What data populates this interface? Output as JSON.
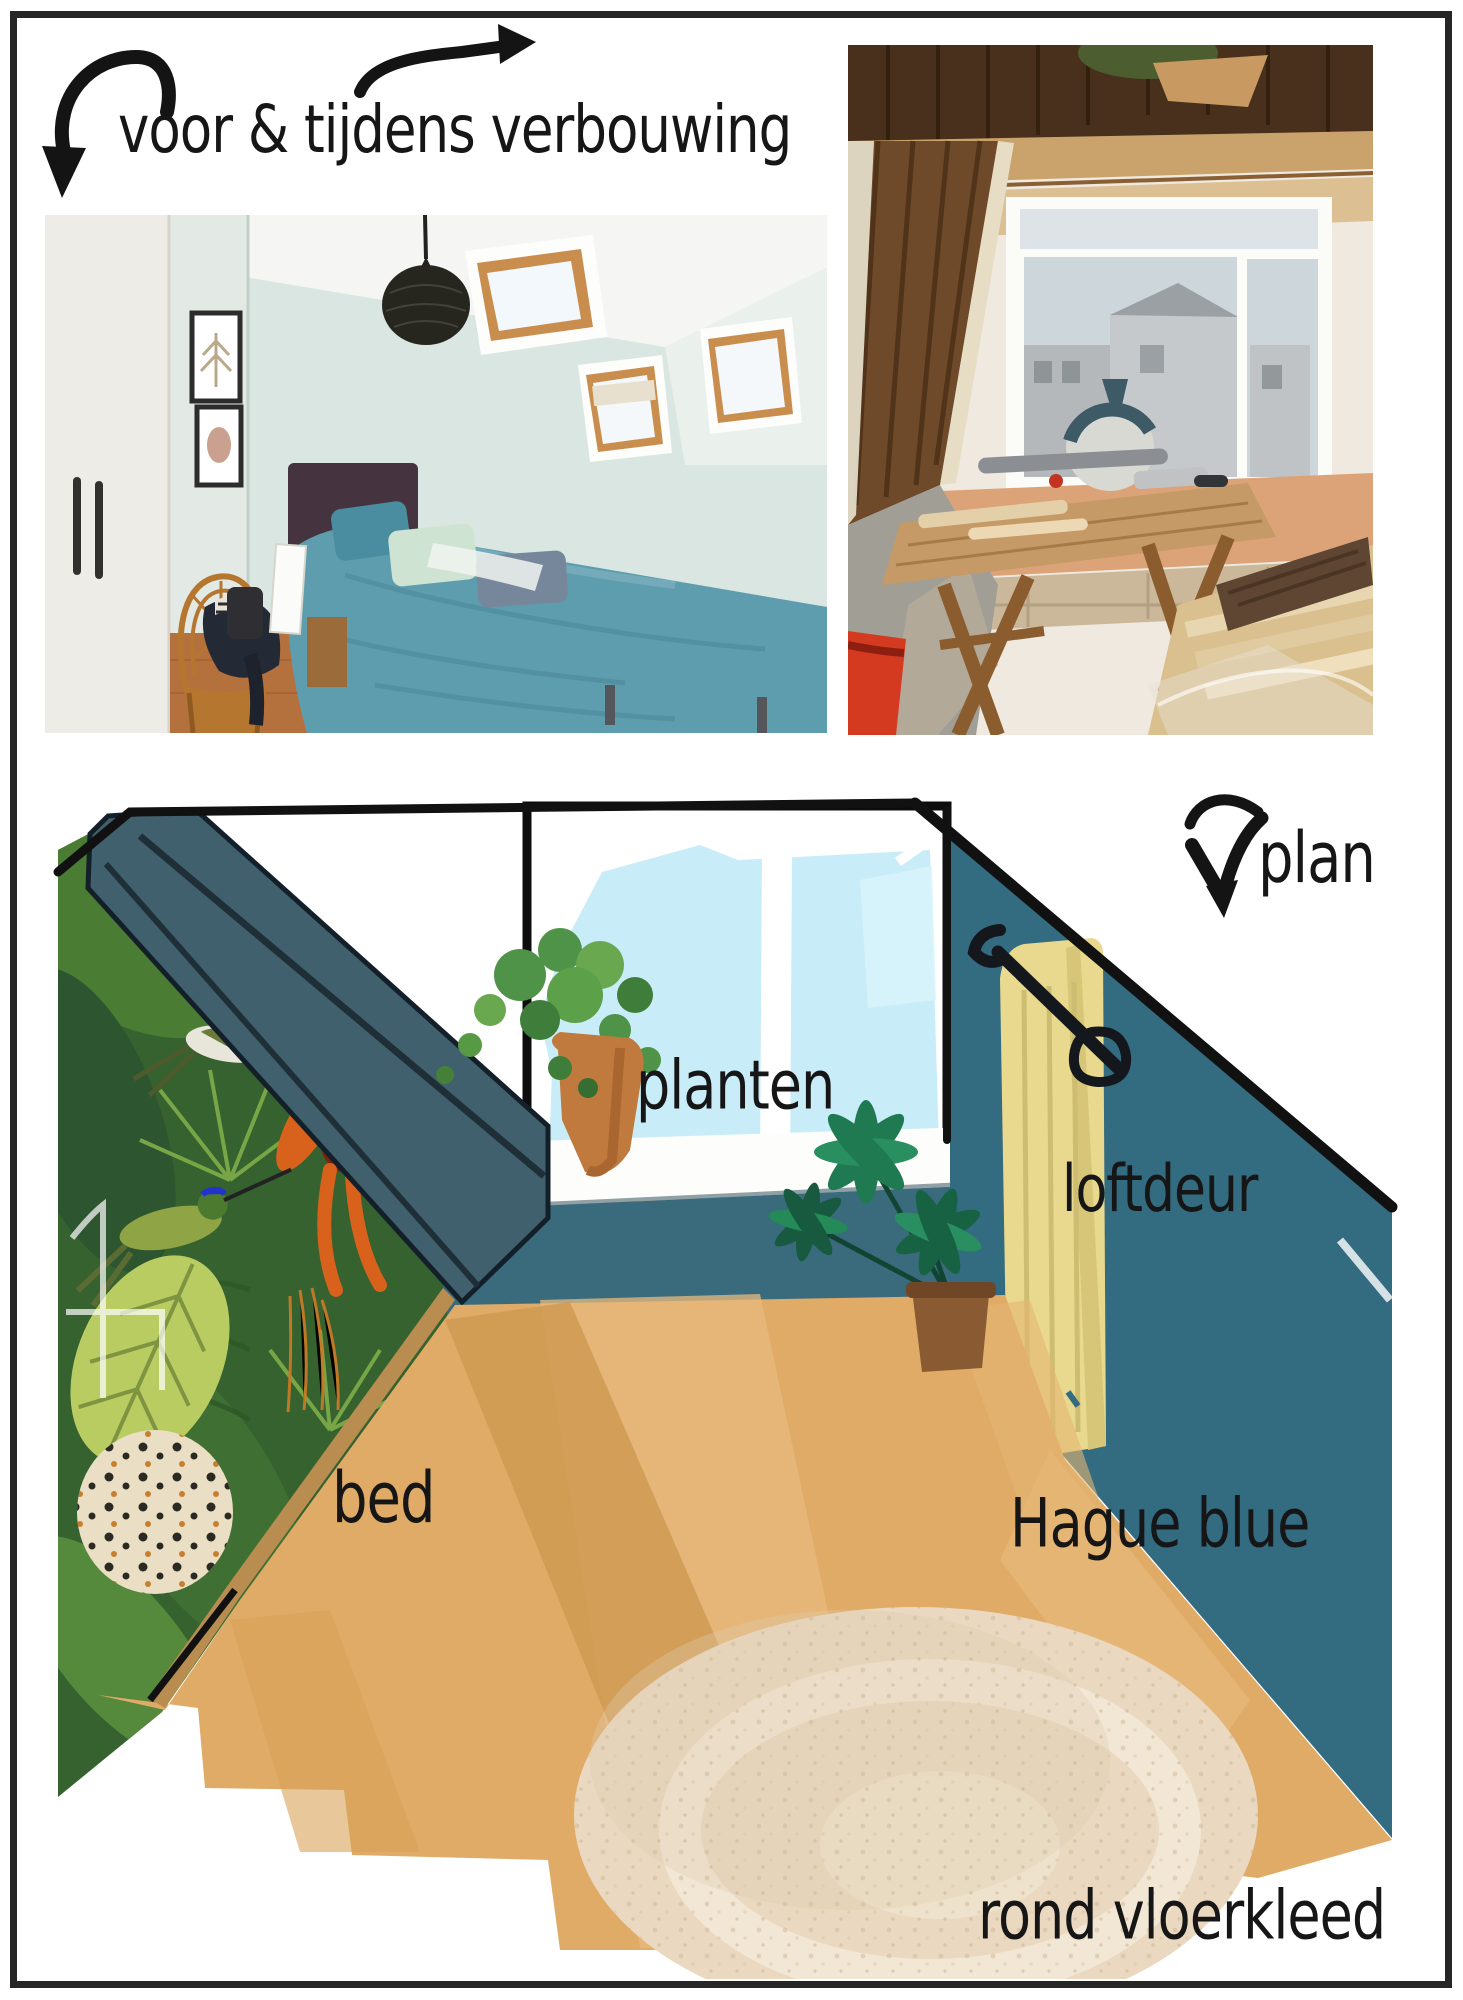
{
  "header": {
    "title": "voor & tijdens verbouwing"
  },
  "plan": {
    "label": "plan",
    "planten": "planten",
    "loftdeur": "loftdeur",
    "bed": "bed",
    "wall_paint": "Hague blue",
    "rug": "rond vloerkleed"
  },
  "colors": {
    "ink": "#141414",
    "hague_blue": "#336b80",
    "sloped_ceiling": "#41606d",
    "window_sky": "#c9edf8",
    "loft_door": "#e9d98e",
    "floor_wood": "#dfab66",
    "rug": "#ead9c0",
    "bed_teal": "#5e9dae"
  }
}
